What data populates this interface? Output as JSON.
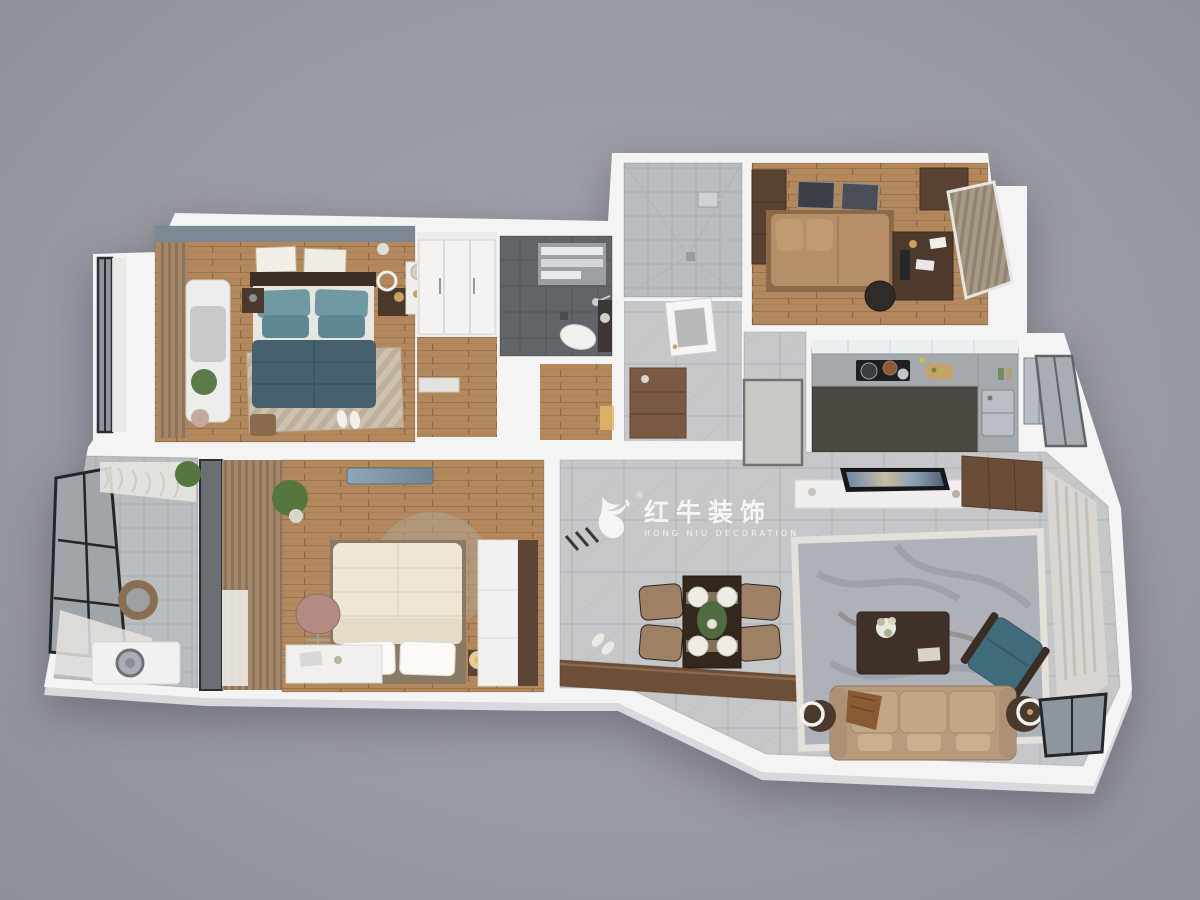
{
  "watermark": {
    "brand_zh": "红牛装饰",
    "brand_en": "HONG NIU DECORATION",
    "registered_mark": "®",
    "logo": "hongniu-bull-icon"
  },
  "palette": {
    "background": "#999ba3",
    "wall": "#f4f4f5",
    "wall_side": "#d9d9dd",
    "wood_floor": "#b2885c",
    "wood_floor_line": "#9c744c",
    "marble_tile": "#c6c7c9",
    "marble_line": "#b5b6b9",
    "dark_tile": "#61656a",
    "light_tile": "#babdbf",
    "accent_wall": "#7c8894",
    "teal_duvet": "#46616d",
    "teal_pillow": "#6f99a3",
    "cream_bed": "#ece5d4",
    "tan_bed": "#b68f68",
    "sofa_tan": "#b79b7d",
    "armchair_teal": "#3f6b7a",
    "dark_wood": "#5a4233",
    "cabinet_brown": "#6b4c37",
    "counter_gray": "#a4a9ad",
    "rug_beige": "#cdc2b0",
    "rug_living": "#aeb1b8",
    "curtain_sheer": "#d9d6d1",
    "glass": "#a7adb2"
  },
  "scene": {
    "type": "3d-apartment-floorplan-render",
    "view": "top-down",
    "rooms": [
      {
        "id": "master-bedroom",
        "floor": "wood",
        "items": [
          "teal-double-bed",
          "striped-rug",
          "nightstands",
          "wall-frames",
          "chaise-bench",
          "wood-blinds",
          "dresser-mirror",
          "stool",
          "slippers"
        ]
      },
      {
        "id": "bay-window",
        "floor": "white",
        "items": [
          "glass-window",
          "sheer-curtain"
        ]
      },
      {
        "id": "walk-in-closet",
        "floor": "wood",
        "items": [
          "white-wardrobe"
        ]
      },
      {
        "id": "master-bathroom",
        "floor": "dark-tile",
        "items": [
          "towel-rack",
          "shower-set",
          "toilet",
          "vanity-sink"
        ]
      },
      {
        "id": "shower-room",
        "floor": "light-tile",
        "items": [
          "rain-shower",
          "shower-column"
        ]
      },
      {
        "id": "entry-hall",
        "floor": "gray-tile",
        "items": [
          "entry-door",
          "shoe-cabinet",
          "floor-inlay",
          "warm-light"
        ]
      },
      {
        "id": "bedroom-2",
        "floor": "wood",
        "items": [
          "tan-tatami-bed",
          "wardrobes",
          "desk",
          "office-chair",
          "monitor",
          "window-blinds",
          "wall-frames"
        ]
      },
      {
        "id": "kitchen",
        "floor": "dark-tile",
        "items": [
          "l-shaped-counter",
          "cooktop",
          "pots",
          "cutting-board",
          "double-sink",
          "fridge",
          "window"
        ]
      },
      {
        "id": "dining-area",
        "floor": "marble-tile",
        "items": [
          "dining-table",
          "four-chairs",
          "place-settings",
          "centerpiece-plant",
          "sideboard-panel",
          "slippers",
          "coat-hooks"
        ]
      },
      {
        "id": "living-room",
        "floor": "marble-tile",
        "items": [
          "tv-console",
          "tv",
          "tall-cabinet",
          "area-rug",
          "coffee-table",
          "flower-vase",
          "three-seat-sofa",
          "throw-blanket",
          "side-table-lamps",
          "teal-armchair",
          "sheer-curtains",
          "windows"
        ]
      },
      {
        "id": "bedroom-3",
        "floor": "wood",
        "items": [
          "cream-bed",
          "round-rug",
          "white-desk",
          "desk-chair",
          "plant",
          "air-conditioner",
          "wood-blinds",
          "wardrobe",
          "bedside-lamp"
        ]
      },
      {
        "id": "laundry-balcony",
        "floor": "light-tile",
        "items": [
          "glass-windows",
          "sheer-curtains",
          "washer-counter",
          "washing-machine",
          "basket",
          "plant"
        ]
      }
    ]
  }
}
